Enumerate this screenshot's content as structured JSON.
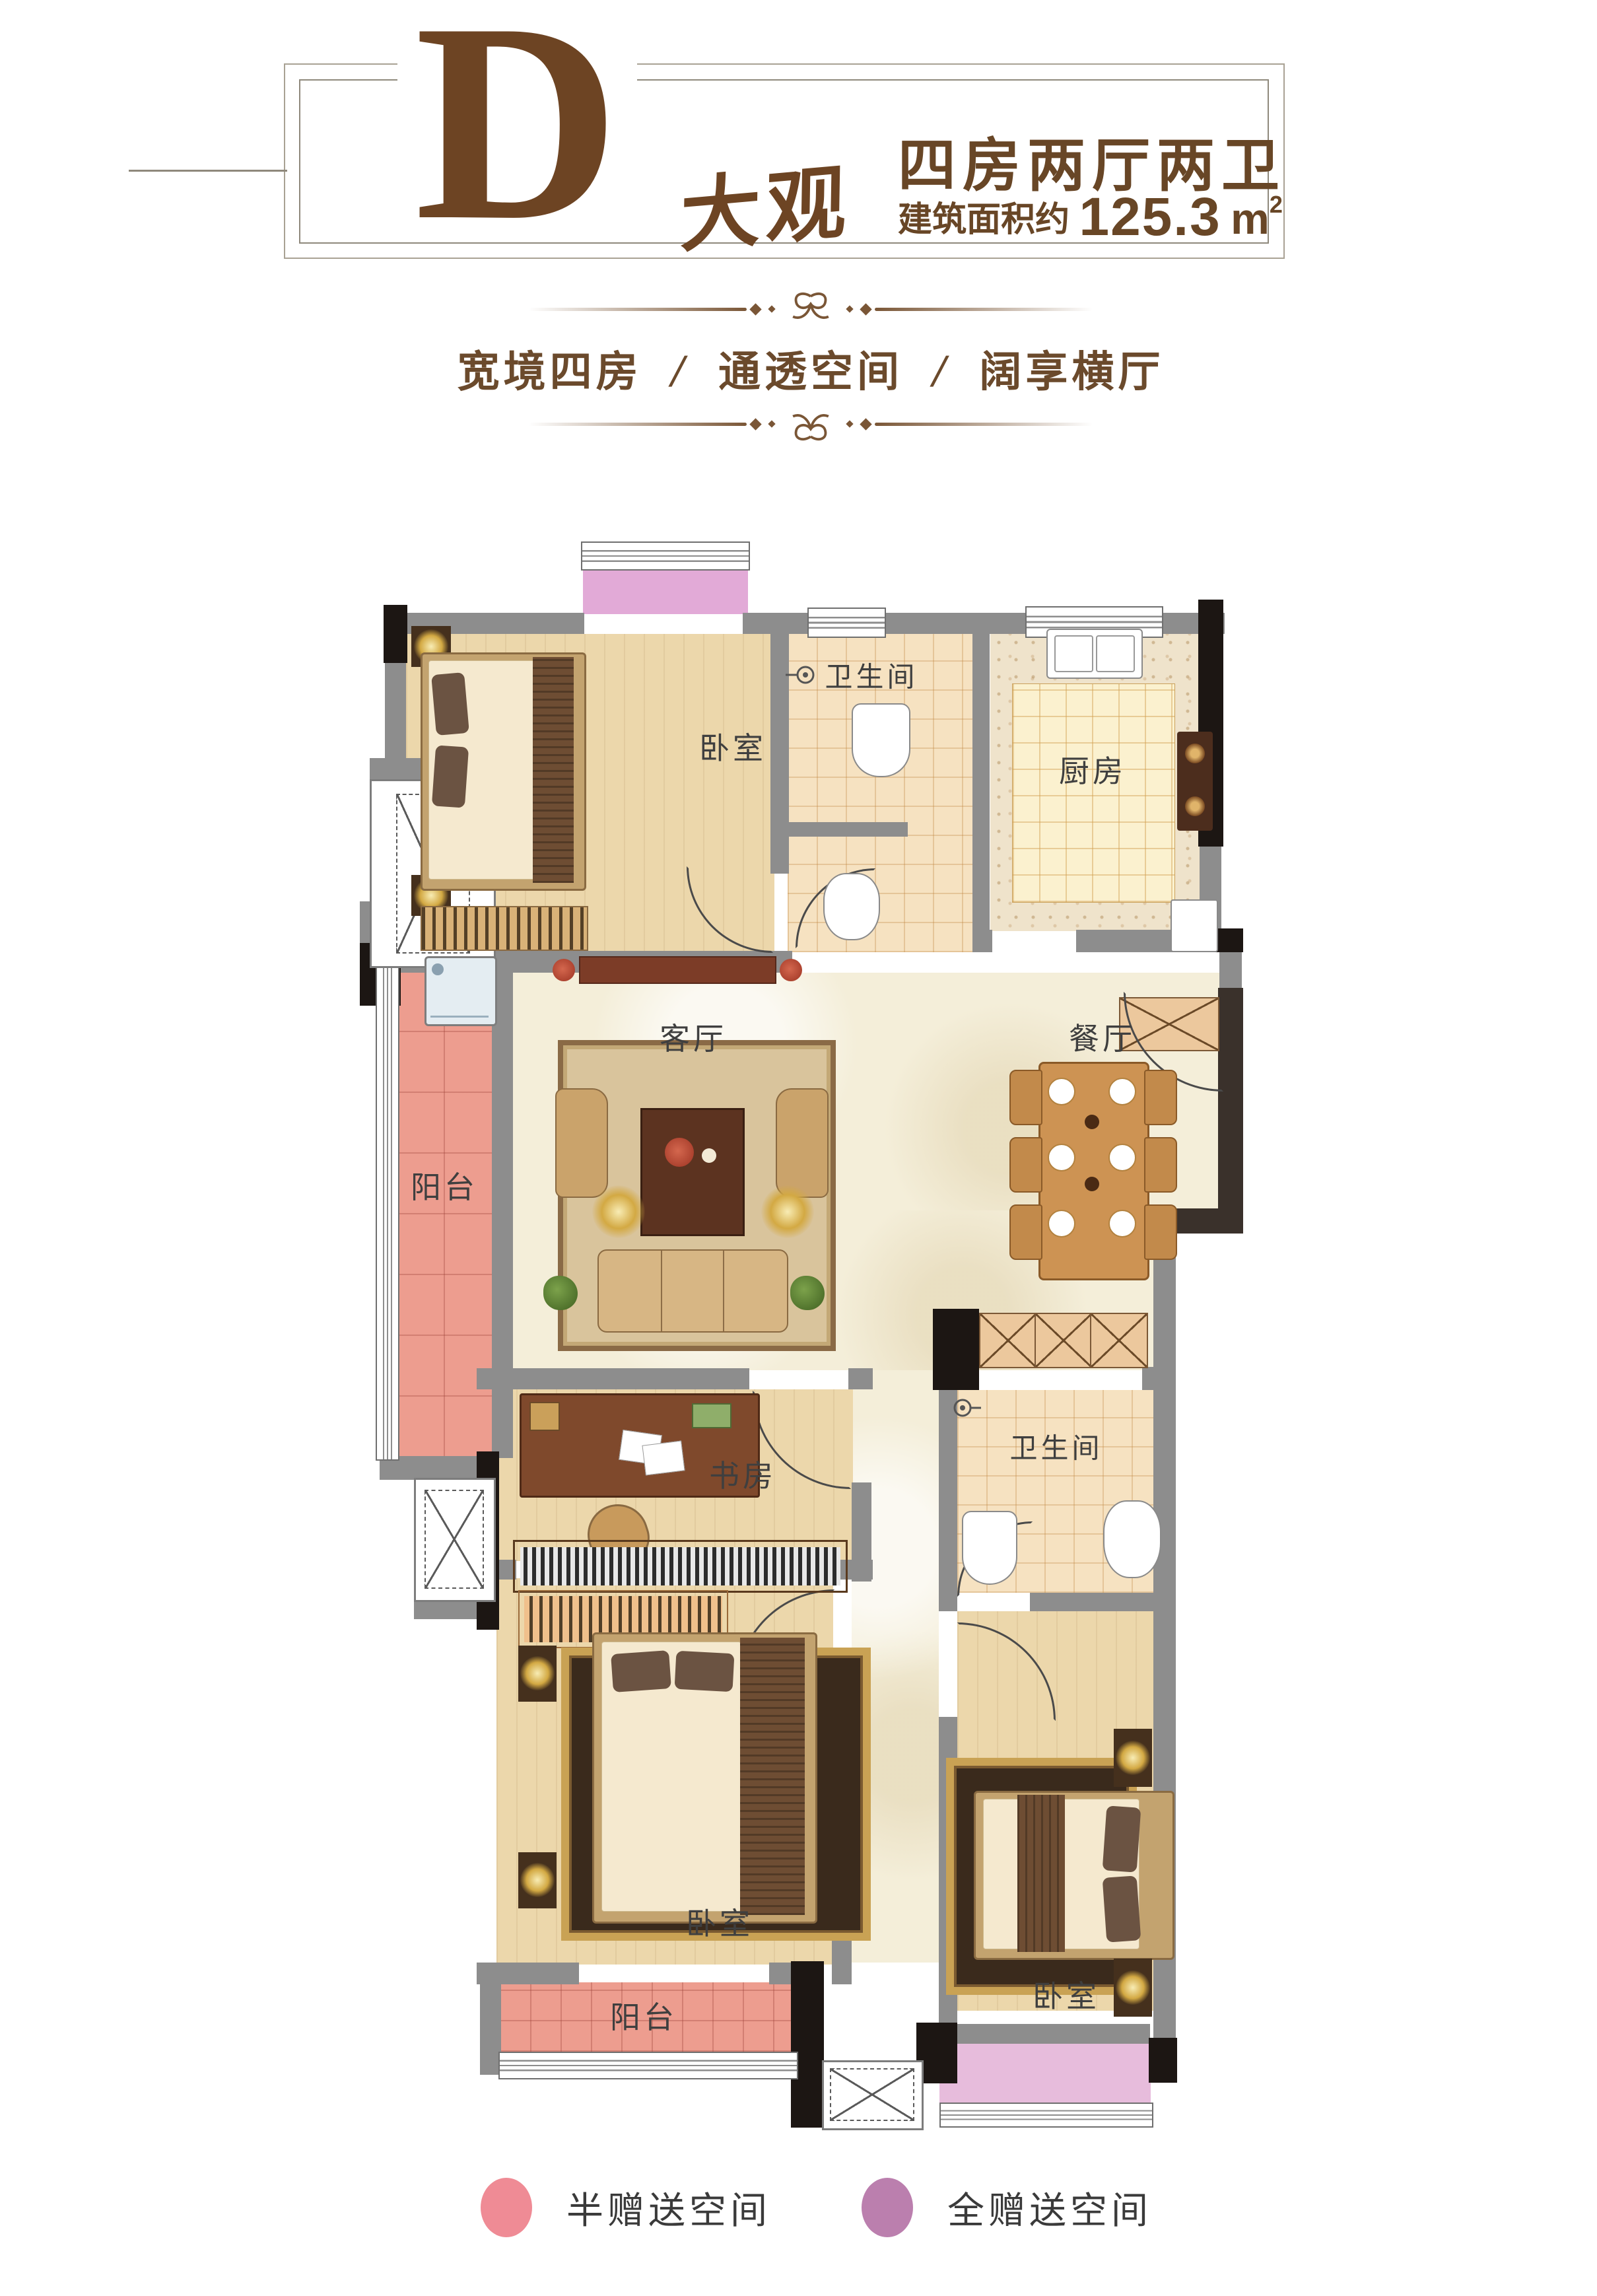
{
  "header": {
    "letter": "D",
    "letter_suffix": "大观",
    "spec_title": "四房两厅两卫",
    "area_label": "建筑面积约",
    "area_value": "125.3",
    "area_unit": "m",
    "area_sup": "2",
    "tagline": [
      "宽境四房",
      "通透空间",
      "阔享横厅"
    ],
    "tagline_separator": "/"
  },
  "plan": {
    "labels": {
      "bedroom_top": "卧室",
      "bath_top": "卫生间",
      "kitchen": "厨房",
      "living": "客厅",
      "dining": "餐厅",
      "balcony_left": "阳台",
      "study": "书房",
      "bath_mid": "卫生间",
      "bedroom_left": "卧室",
      "bedroom_right": "卧室",
      "balcony_bottom": "阳台"
    }
  },
  "legend": {
    "items": [
      {
        "label": "半赠送空间",
        "color": "#ef8b95"
      },
      {
        "label": "全赠送空间",
        "color": "#bb7fae"
      }
    ]
  },
  "colors": {
    "accent_brown": "#6d4423",
    "wall_gray": "#8d8d8d",
    "wall_black": "#1c1613",
    "balcony_pink": "#ed9d8f",
    "gift_purple_top": "#e2aad7",
    "gift_purple_bottom": "#e7bcdc",
    "floor_wood": "#ecd7ab",
    "floor_marble": "#f4eed9",
    "floor_tile": "#f6e2c1"
  }
}
